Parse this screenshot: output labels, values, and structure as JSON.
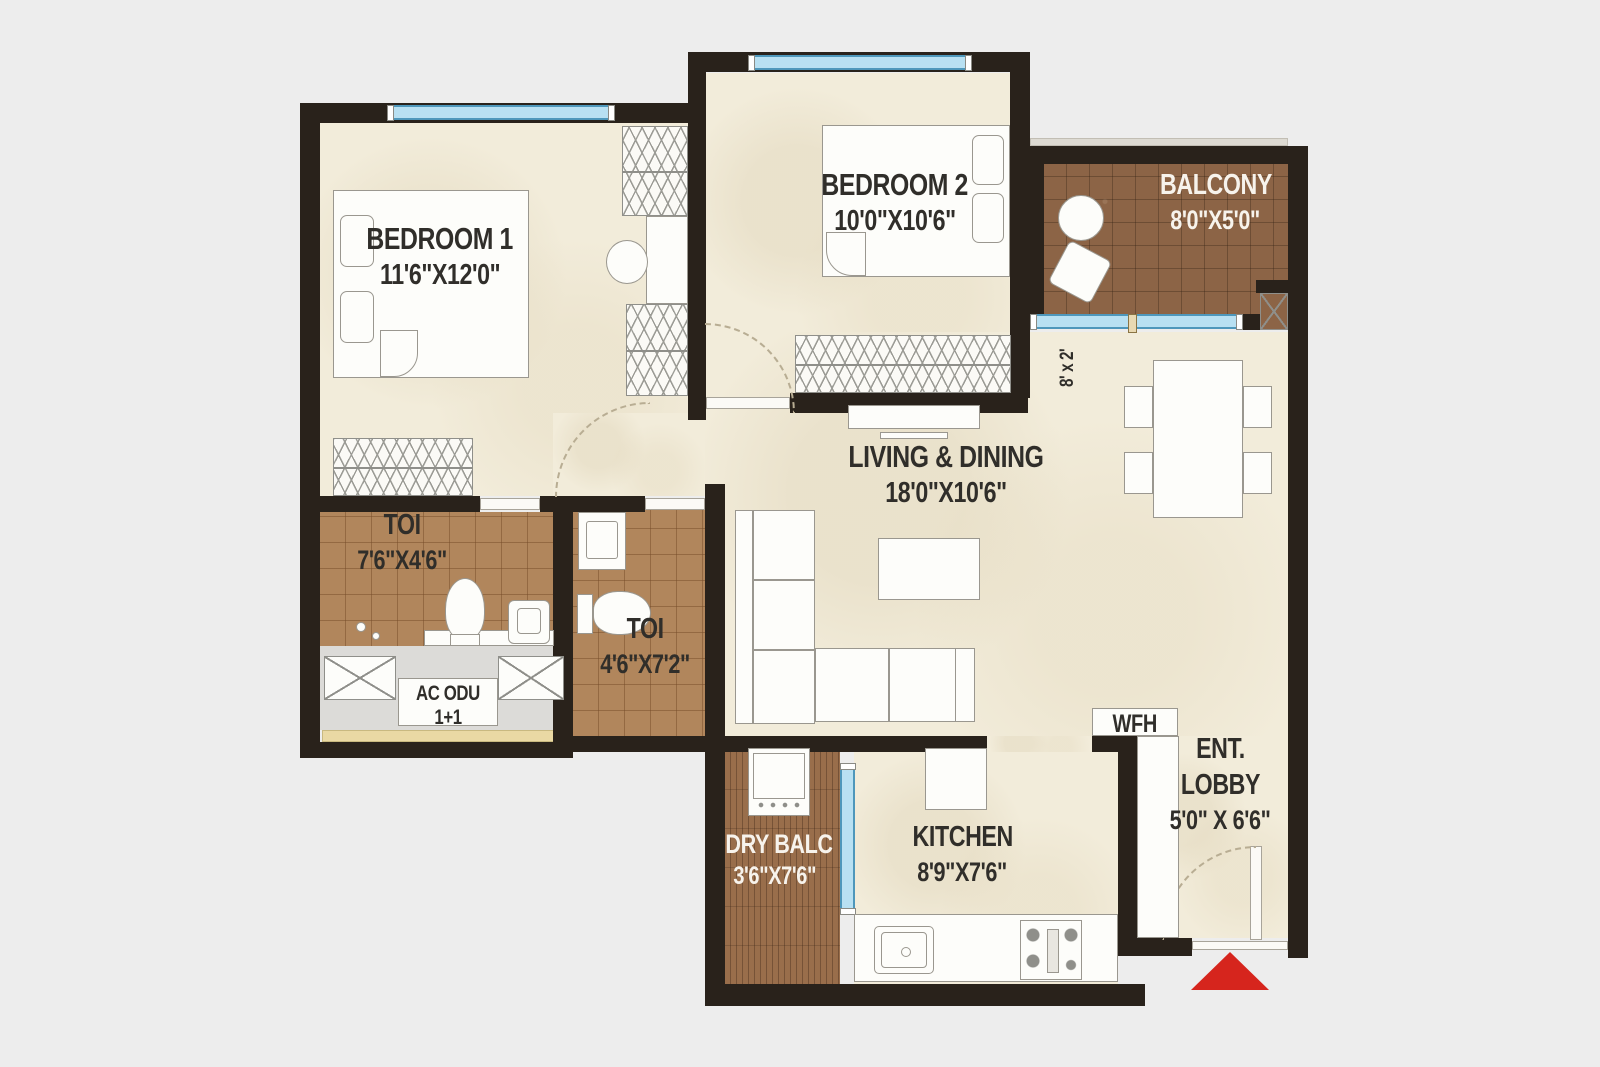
{
  "rooms": {
    "bedroom1": {
      "name": "BEDROOM 1",
      "dims": "11'6\"X12'0\""
    },
    "bedroom2": {
      "name": "BEDROOM 2",
      "dims": "10'0\"X10'6\""
    },
    "balcony": {
      "name": "BALCONY",
      "dims": "8'0\"X5'0\""
    },
    "living_dining": {
      "name": "LIVING & DINING",
      "dims": "18'0\"X10'6\""
    },
    "toilet_1": {
      "name": "TOI",
      "dims": "7'6\"X4'6\""
    },
    "toilet_2": {
      "name": "TOI",
      "dims": "4'6\"X7'2\""
    },
    "dry_balcony": {
      "name": "DRY BALC",
      "dims": "3'6\"X7'6\""
    },
    "kitchen": {
      "name": "KITCHEN",
      "dims": "8'9\"X7'6\""
    },
    "entrance_lobby": {
      "name_line_1": "ENT.",
      "name_line_2": "LOBBY",
      "dims": "5'0\" X 6'6\""
    },
    "wfh_nook": {
      "name": "WFH"
    },
    "ac_unit": {
      "name": "AC ODU",
      "count": "1+1"
    },
    "window_ledge": {
      "size": "8' x 2'"
    }
  },
  "furniture_icons": [
    "double-bed",
    "pillow",
    "wardrobe",
    "study-desk",
    "desk-chair",
    "dining-table",
    "dining-chair",
    "l-shaped-sofa",
    "coffee-table",
    "tv-unit",
    "fridge",
    "kitchen-sink",
    "hob-stove",
    "kitchen-counter",
    "washing-machine",
    "wc-toilet",
    "washbasin",
    "vanity-counter",
    "round-table",
    "balcony-chair",
    "ac-outdoor-unit",
    "entry-arrow",
    "door-swing-arc",
    "window",
    "sliding-window"
  ],
  "colors": {
    "background": "#ededed",
    "wall": "#29221b",
    "floor_cream": "#f2ecda",
    "toilet_tile": "#b1865c",
    "balcony_tile": "#8c6446",
    "dry_balcony_tile": "#996e4b",
    "window_glass": "#b8e0f2",
    "window_frame": "#4e97bb",
    "ac_ledge_strip": "#ead9a4",
    "entry_arrow": "#d6251d",
    "label_dark": "#302e2a",
    "label_light": "#f7f3ec"
  }
}
